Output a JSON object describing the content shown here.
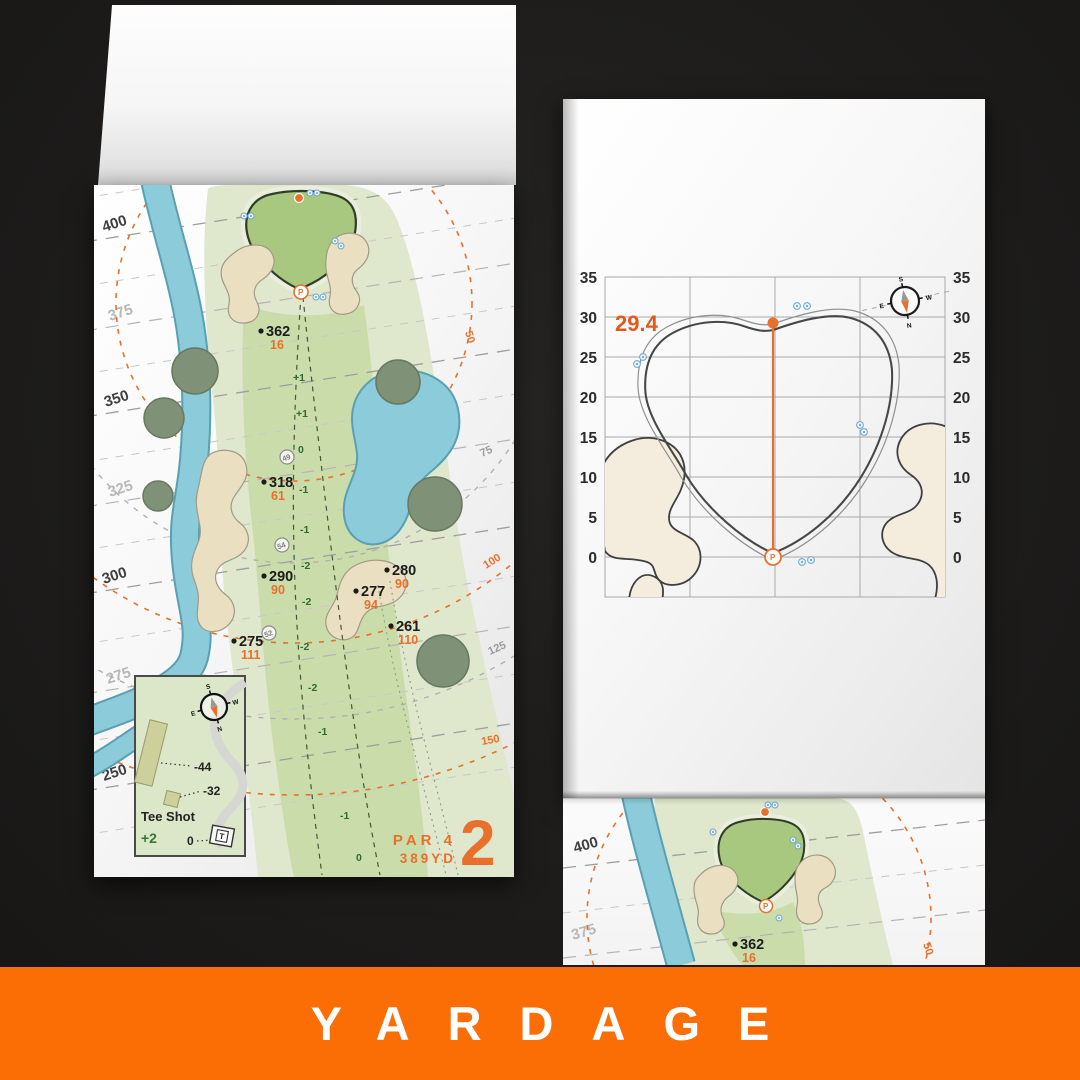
{
  "banner": {
    "label": "YARDAGE",
    "bg": "#fb6d05",
    "fg": "#ffffff"
  },
  "colors": {
    "accent_orange": "#e8702a",
    "banner_orange": "#fb6d05",
    "water": "#8ccbd9",
    "green_surface": "#a9c87f",
    "fairway": "#cbdcab",
    "rough": "#dfe7cd",
    "sand": "#ebdfc2",
    "ink": "#1c1c1c"
  },
  "compass": {
    "n": "N",
    "s": "S",
    "e": "E",
    "w": "W"
  },
  "icons": {
    "pin": "P"
  },
  "left_page": {
    "distances": [
      "400",
      "375",
      "350",
      "325",
      "300",
      "275",
      "250"
    ],
    "arcs": [
      "50",
      "75",
      "100",
      "125",
      "150"
    ],
    "markers": [
      {
        "yards": "362",
        "carry": "16"
      },
      {
        "yards": "318",
        "carry": "61"
      },
      {
        "yards": "290",
        "carry": "90"
      },
      {
        "yards": "280",
        "carry": "90"
      },
      {
        "yards": "277",
        "carry": "94"
      },
      {
        "yards": "261",
        "carry": "110"
      },
      {
        "yards": "275",
        "carry": "111"
      }
    ],
    "slopes": [
      "+1",
      "+1",
      "0",
      "-1",
      "-1",
      "-2",
      "-2",
      "-2",
      "-2",
      "-1",
      "-1",
      "0"
    ],
    "checkpoints": [
      "49",
      "54",
      "52"
    ],
    "inset": {
      "title": "Tee Shot",
      "score": "+2",
      "offsets": [
        "-44",
        "-32",
        "0"
      ],
      "tee": "T"
    },
    "hole": {
      "par": "PAR 4",
      "yardage": "389YD",
      "number": "2"
    }
  },
  "right_page": {
    "depth": "29.4",
    "axis": [
      "35",
      "30",
      "25",
      "20",
      "15",
      "10",
      "5",
      "0"
    ],
    "partial": {
      "distances": [
        "400",
        "375"
      ],
      "arc": "50",
      "marker": {
        "yards": "362",
        "carry": "16"
      }
    }
  },
  "chart_data": {
    "type": "line",
    "title": "Green depth grid — hole 2",
    "ylabel": "yards",
    "y_ticks": [
      35,
      30,
      25,
      20,
      15,
      10,
      5,
      0
    ],
    "ylim": [
      -5,
      35
    ],
    "grid": true,
    "legend": false,
    "series": [
      {
        "name": "green-depth-marker",
        "values": [
          {
            "from": 0,
            "to": 29.4
          }
        ]
      }
    ],
    "annotations": [
      "29.4"
    ]
  }
}
